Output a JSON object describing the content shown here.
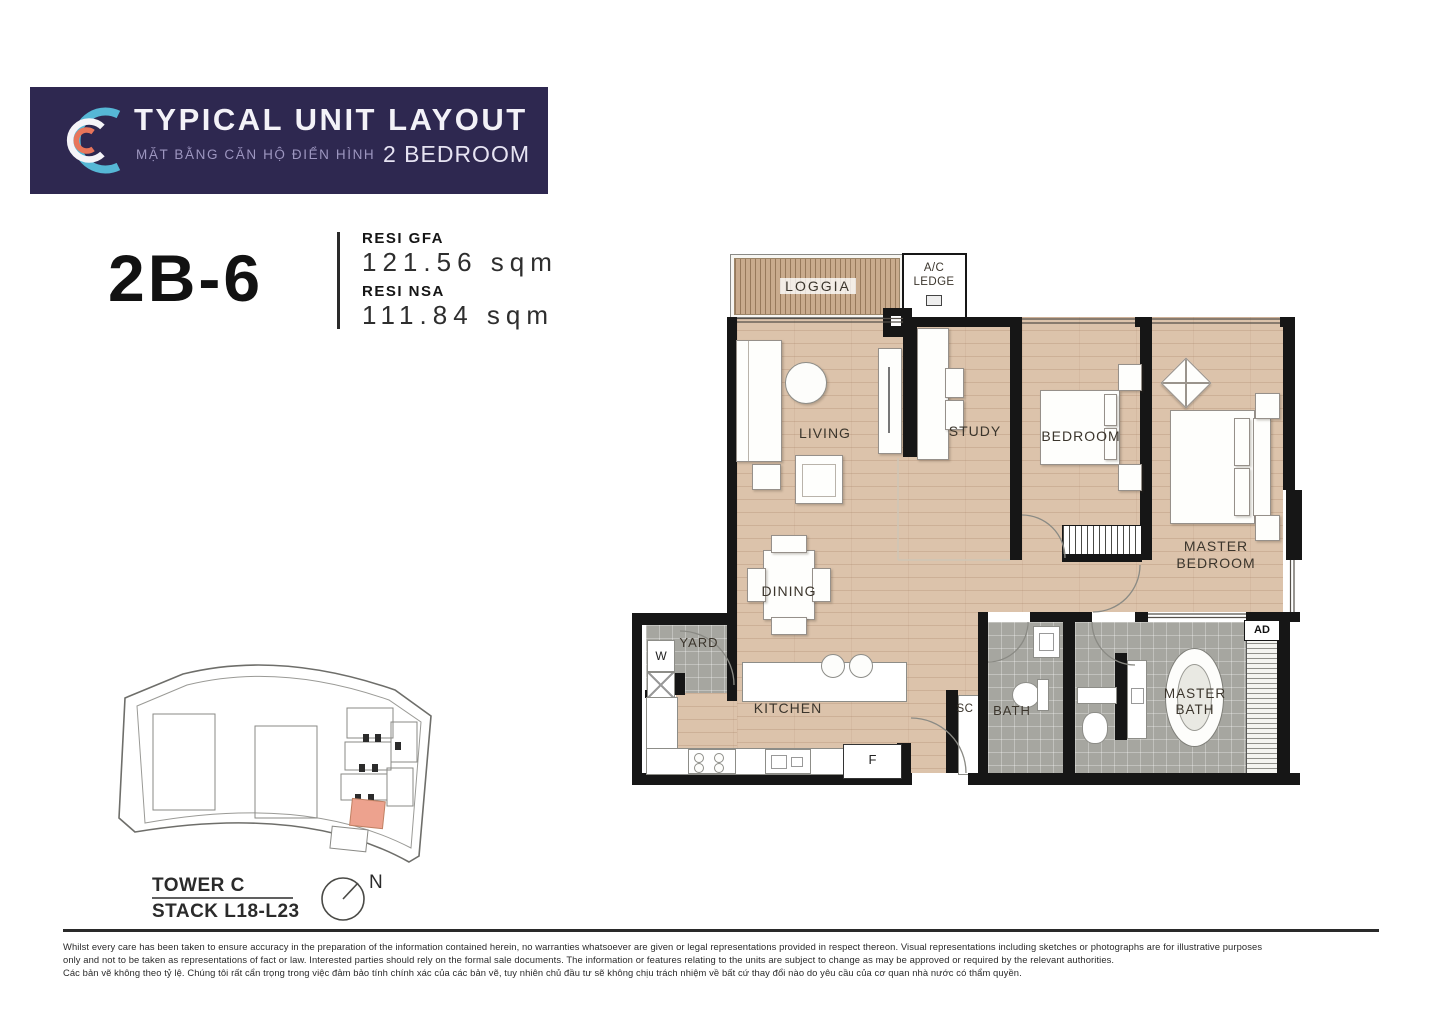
{
  "header": {
    "title": "TYPICAL UNIT LAYOUT",
    "subtitle_vi": "MẶT BẰNG CĂN HỘ ĐIỂN HÌNH",
    "bedroom_tag": "2 BEDROOM",
    "logo_icon": "concentric-c-marks"
  },
  "unit": {
    "code": "2B-6",
    "gfa_label": "RESI GFA",
    "gfa_value": "121.56 sqm",
    "nsa_label": "RESI NSA",
    "nsa_value": "111.84 sqm"
  },
  "plan": {
    "rooms": {
      "loggia": "LOGGIA",
      "ac_ledge": "A/C LEDGE",
      "living": "LIVING",
      "study": "STUDY",
      "bedroom": "BEDROOM",
      "master_bedroom": "MASTER BEDROOM",
      "dining": "DINING",
      "yard": "YARD",
      "kitchen": "KITCHEN",
      "bath": "BATH",
      "master_bath": "MASTER BATH",
      "sc": "SC",
      "ad": "AD",
      "washer": "W",
      "fridge": "F"
    }
  },
  "keyplan": {
    "tower": "TOWER C",
    "stack": "STACK L18-L23",
    "north": "N"
  },
  "disclaimer": {
    "lines": [
      "Whilst every care has been taken to ensure accuracy in the preparation of the information contained herein, no warranties whatsoever are given or legal representations provided in respect thereon. Visual representations including sketches or photographs are for illustrative purposes",
      "only and not to be taken as representations of fact or law. Interested parties should rely on the formal sale documents. The information or features relating to the units are subject to change as may be approved or required by the relevant authorities.",
      "Các bản vẽ không theo tỷ lệ. Chúng tôi rất cẩn trọng trong việc đảm bảo tính chính xác của các bản vẽ, tuy nhiên chủ đầu tư sẽ không chịu trách nhiệm về bất cứ thay đổi nào do yêu cầu của cơ quan nhà nước có thẩm quyền."
    ]
  },
  "colors": {
    "header_bg": "#2e2850",
    "logo_blue": "#56b7d6",
    "logo_orange": "#e8755a",
    "wood_floor": "#dcc3ab",
    "tile_gray": "#a6a6a0",
    "wall_black": "#161616",
    "keyplan_highlight": "#eda28e"
  }
}
